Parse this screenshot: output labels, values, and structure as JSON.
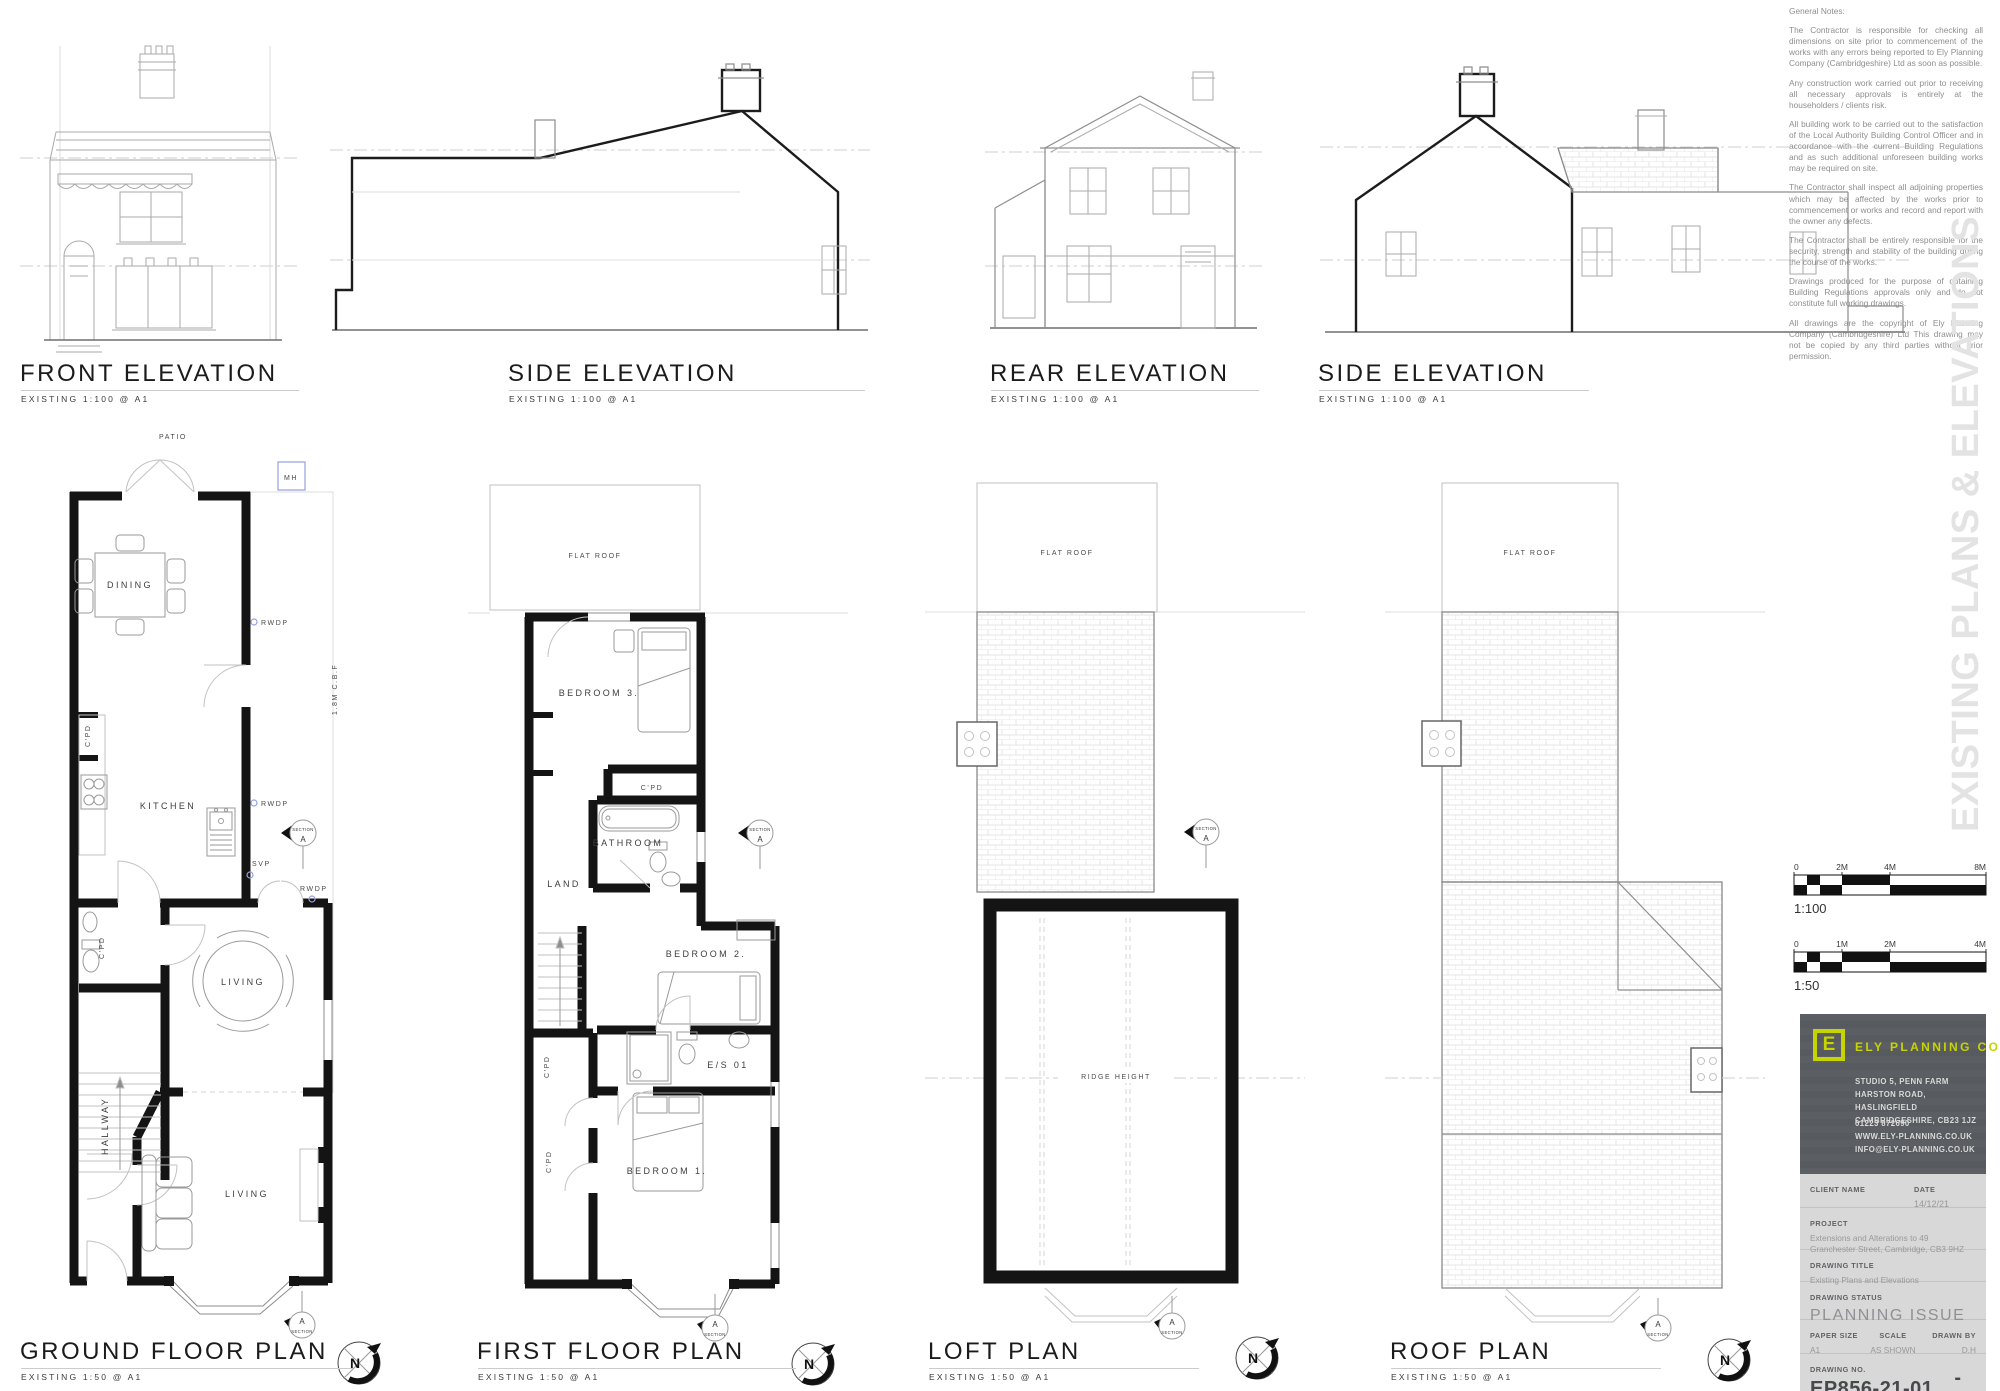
{
  "notes": {
    "title": "General Notes:",
    "paragraphs": [
      "The Contractor is responsible for checking all dimensions on site prior to commencement of the works with any errors being reported to Ely Planning Company (Cambridgeshire) Ltd as soon as possible.",
      "Any construction work carried out prior to receiving all necessary approvals is entirely at the householders / clients risk.",
      "All building work to be carried out to the satisfaction of the Local Authority Building Control Officer and in accordance with the current Building Regulations and as such additional unforeseen building works may be required on site.",
      "The Contractor shall inspect all adjoining properties which may be affected by the works prior to commencement or works and record and report with the owner any defects.",
      "The Contractor shall be entirely responsible for the security, strength and stability of the building during the course of the works.",
      "Drawings produced for the purpose of obtaining Building Regulations approvals only and do not constitute full working drawings.",
      "All drawings are the copyright of Ely Planning Company (Cambridgeshire) Ltd This drawing may not be copied by any third parties without prior permission."
    ]
  },
  "elevations": [
    {
      "title": "FRONT ELEVATION",
      "caption": "EXISTING 1:100 @ A1"
    },
    {
      "title": "SIDE ELEVATION",
      "caption": "EXISTING 1:100 @ A1"
    },
    {
      "title": "REAR ELEVATION",
      "caption": "EXISTING 1:100 @ A1"
    },
    {
      "title": "SIDE ELEVATION",
      "caption": "EXISTING 1:100 @ A1"
    }
  ],
  "plans": [
    {
      "title": "GROUND FLOOR PLAN",
      "caption": "EXISTING 1:50 @ A1"
    },
    {
      "title": "FIRST FLOOR PLAN",
      "caption": "EXISTING 1:50 @ A1"
    },
    {
      "title": "LOFT PLAN",
      "caption": "EXISTING 1:50 @ A1"
    },
    {
      "title": "ROOF PLAN",
      "caption": "EXISTING 1:50 @ A1"
    }
  ],
  "plan_labels": {
    "patio": "PATIO",
    "manhole": "MH",
    "dining": "DINING",
    "rwdp": "RWDP",
    "svp": "SVP",
    "fence": "1.8M C.B.F",
    "cupboard": "C'PD",
    "kitchen": "KITCHEN",
    "living": "LIVING",
    "hallway": "HALLWAY",
    "bedroom3": "BEDROOM 3.",
    "bathroom": "BATHROOM",
    "landing": "LAND",
    "bedroom2": "BEDROOM 2.",
    "ensuite": "E/S 01",
    "bedroom1": "BEDROOM 1.",
    "flat_roof": "FLAT ROOF",
    "ridge_height": "RIDGE HEIGHT"
  },
  "markers": {
    "section_word": "SECTION",
    "section_letter": "A",
    "north_letter": "N"
  },
  "side_title": "EXISTING PLANS & ELEVATIONS",
  "scale_bars": [
    {
      "ticks": [
        "0",
        "2M",
        "4M",
        "8M"
      ],
      "ratio": "1:100"
    },
    {
      "ticks": [
        "0",
        "1M",
        "2M",
        "4M"
      ],
      "ratio": "1:50"
    }
  ],
  "title_block": {
    "company": "ELY PLANNING CO.",
    "logo_letter": "E",
    "address_lines": [
      "STUDIO 5, PENN FARM",
      "HARSTON ROAD, HASLINGFIELD",
      "CAMBRIDGESHIRE, CB23 1JZ"
    ],
    "contact_lines": [
      "01223 872690",
      "WWW.ELY-PLANNING.CO.UK",
      "INFO@ELY-PLANNING.CO.UK"
    ],
    "client_name_label": "CLIENT NAME",
    "date_label": "DATE",
    "date_value": "14/12/21",
    "project_label": "PROJECT",
    "project_value": "Extensions and Alterations to 49 Granchester Street, Cambridge, CB3 9HZ",
    "drawing_title_label": "DRAWING TITLE",
    "drawing_title_value": "Existing Plans and Elevations",
    "drawing_status_label": "DRAWING STATUS",
    "drawing_status_value": "PLANNING ISSUE",
    "paper_size_label": "PAPER SIZE",
    "paper_size_value": "A1",
    "scale_label": "SCALE",
    "scale_value": "AS SHOWN",
    "drawn_by_label": "DRAWN BY",
    "drawn_by_value": "D.H",
    "drawing_no_label": "DRAWING NO.",
    "drawing_no_value": "EP856-21-01",
    "revision": "-"
  },
  "colors": {
    "accent": "#c6d400",
    "titleblock_dark": "#5a5d61",
    "titleblock_light": "#d8d8d8"
  }
}
